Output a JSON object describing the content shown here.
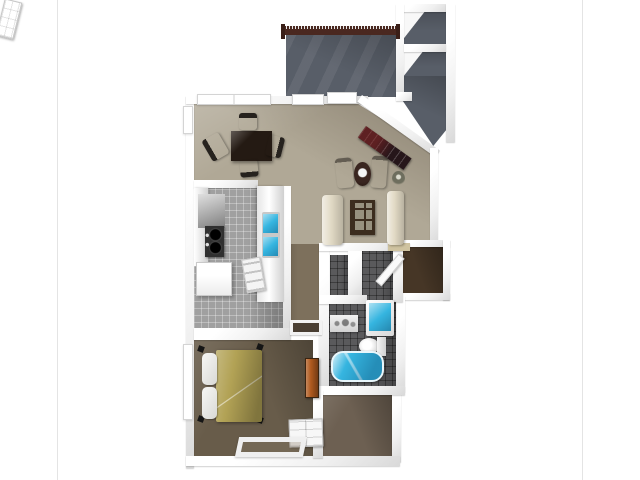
{
  "meta": {
    "description": "3D rendered top-down floor plan photo of a one-bedroom, one-bathroom apartment with balcony, shown on a white listing page"
  },
  "photo": {
    "background": "#ffffff",
    "frame_border_color": "#e4e4e4"
  },
  "floorplan": {
    "colors": {
      "wall": "#f5f5f5",
      "wall_shade": "#d9d9d9",
      "carpet_main": "#b0a896",
      "carpet_hall": "#7d705c",
      "carpet_bedroom": "#685c4a",
      "carpet_closet": "#6d6052",
      "tile_kitchen": "#a0a0a0",
      "tile_bath": "#5a5a5c",
      "patio_floor": "#585e68",
      "railing_wood": "#4a2820",
      "entry_floor": "#463626",
      "fixture_water": "#35b5e0",
      "bed_comforter": "#b2a255",
      "dresser_wood": "#b05a1e",
      "sofa_cream": "#e1d9c4",
      "table_espresso": "#241a13",
      "tv_console": "#26161a"
    },
    "rooms": [
      {
        "label": "Balcony / patio"
      },
      {
        "label": "Patio storage closet"
      },
      {
        "label": "Patio storage closet"
      },
      {
        "label": "Patio walkway"
      },
      {
        "label": "Living / dining room"
      },
      {
        "label": "Kitchen"
      },
      {
        "label": "Hallway"
      },
      {
        "label": "Laundry closet"
      },
      {
        "label": "Bathroom corridor"
      },
      {
        "label": "Entry"
      },
      {
        "label": "Bathroom"
      },
      {
        "label": "Bedroom"
      },
      {
        "label": "Walk-in closet"
      }
    ],
    "furniture": [
      {
        "label": "Dining table"
      },
      {
        "label": "Dining chair"
      },
      {
        "label": "Dining chair"
      },
      {
        "label": "Dining chair"
      },
      {
        "label": "Dining chair"
      },
      {
        "label": "TV console"
      },
      {
        "label": "Accent chair"
      },
      {
        "label": "Accent chair"
      },
      {
        "label": "Lamp table"
      },
      {
        "label": "Potted plant"
      },
      {
        "label": "Sofa"
      },
      {
        "label": "Sofa"
      },
      {
        "label": "Glass coffee table"
      },
      {
        "label": "Kitchen counter"
      },
      {
        "label": "Wall cabinet"
      },
      {
        "label": "Stove"
      },
      {
        "label": "Refrigerator"
      },
      {
        "label": "Kitchen counter"
      },
      {
        "label": "Double kitchen sink"
      },
      {
        "label": "Dishwasher door"
      },
      {
        "label": "Bathroom counter"
      },
      {
        "label": "Vanity sink"
      },
      {
        "label": "Toilet"
      },
      {
        "label": "Bathtub"
      },
      {
        "label": "Bed"
      },
      {
        "label": "Pillow"
      },
      {
        "label": "Pillow"
      },
      {
        "label": "Comforter"
      },
      {
        "label": "Tall dresser"
      },
      {
        "label": "Chest of drawers"
      },
      {
        "label": "Floor mat"
      },
      {
        "label": "Front door"
      },
      {
        "label": "Closet door"
      },
      {
        "label": "Entry shelf"
      },
      {
        "label": "Balcony railing"
      },
      {
        "label": "Window"
      },
      {
        "label": "Window"
      },
      {
        "label": "Patio door"
      },
      {
        "label": "Window"
      },
      {
        "label": "Window"
      },
      {
        "label": "Doorway threshold"
      }
    ]
  }
}
